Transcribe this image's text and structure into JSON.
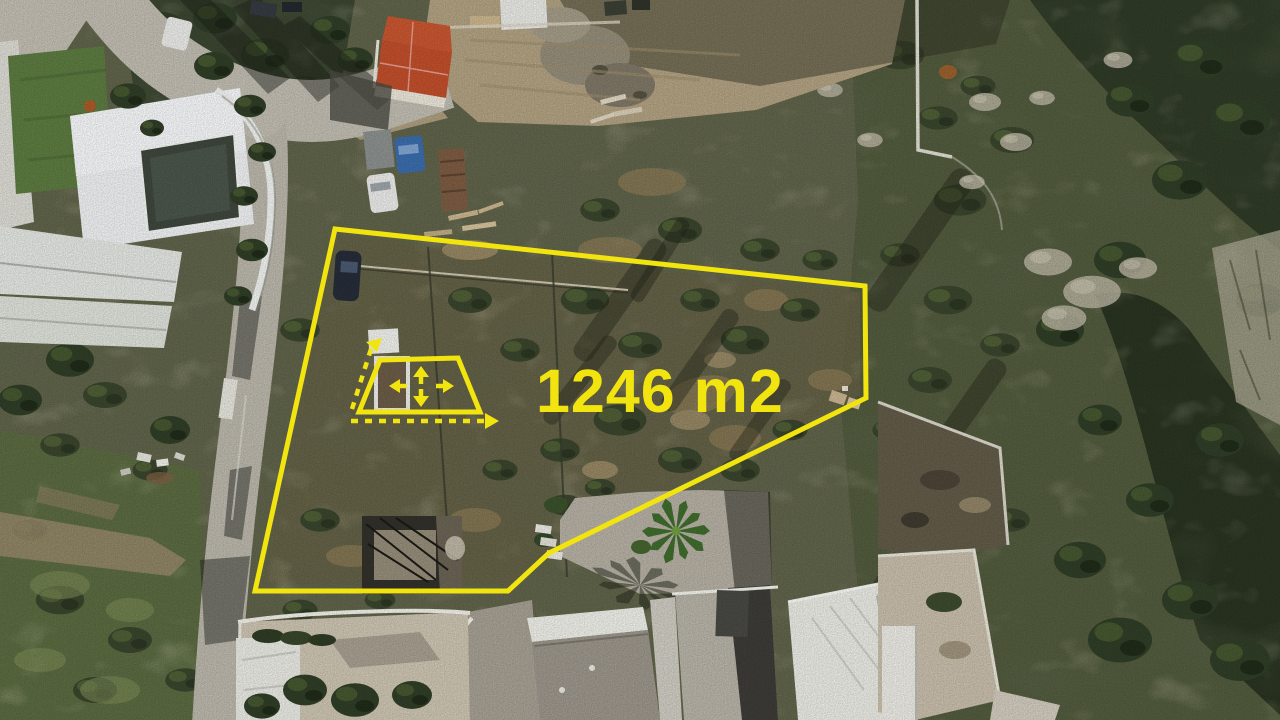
{
  "scene": {
    "type": "aerial-drone-photo",
    "subject": "vacant hillside land plot outlined for sale, surrounded by villas, roads and scrubland"
  },
  "annotation": {
    "area_label": "1246 m2",
    "accent_color": "#f2e40e",
    "icon": "area-measure-icon"
  }
}
